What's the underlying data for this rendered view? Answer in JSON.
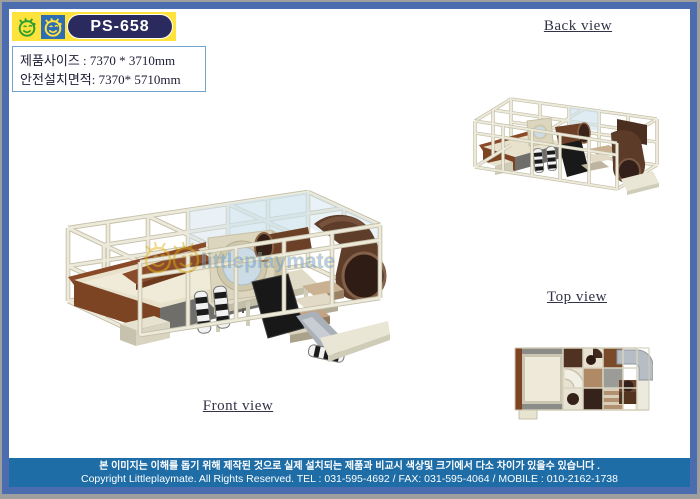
{
  "logo": {
    "model": "PS-658",
    "icons": [
      "smiley-face-green-icon",
      "smiley-face-blue-icon"
    ]
  },
  "info": {
    "line1": "제품사이즈 : 7370 * 3710mm",
    "line2": "안전설치면적: 7370* 5710mm"
  },
  "views": {
    "front": {
      "label": "Front view"
    },
    "back": {
      "label": "Back view"
    },
    "top": {
      "label": "Top view"
    }
  },
  "watermark": {
    "text": "littleplaymate"
  },
  "footer": {
    "line1": "본 이미지는 이해를 돕기 위해 제작된 것으로 실제 설치되는 제품과 비교시 색상및 크기에서 다소 차이가 있을수 있습니다 .",
    "line2": "Copyright Littleplaymate. All Rights Reserved. TEL : 031-595-4692 / FAX: 031-595-4064 / MOBILE : 010-2162-1738"
  },
  "colors": {
    "frame_border": "#4c6cb0",
    "outer_gray": "#9e9e9e",
    "logo_yellow": "#ffe33c",
    "logo_blue": "#2e6cb4",
    "badge_navy": "#2b2a5e",
    "info_border": "#74a3cb",
    "footer_teal": "#1e6da6",
    "structure_cream": "#e9e6d6",
    "structure_brown": "#7c4423",
    "structure_dark_brown": "#5f3d2b",
    "structure_gray": "#6f6e6b"
  }
}
